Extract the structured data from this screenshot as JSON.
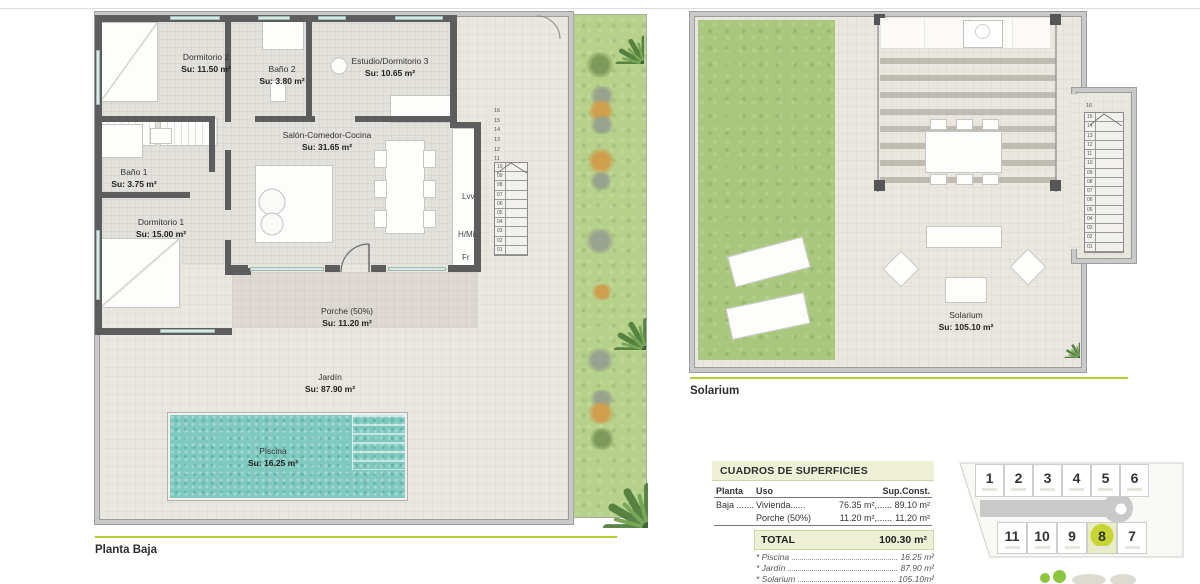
{
  "colors": {
    "accent_green": "#b6cc32",
    "plot_highlight": "#c4d336",
    "pool": "#7fc9bf",
    "grass": "#a9c87d",
    "garden_strip": "#b6d18a",
    "wall": "#5d5d5d",
    "table_header_bg": "#eef0d6"
  },
  "left_plan": {
    "section_label": "Planta Baja",
    "rooms": [
      {
        "name": "Dormitorio 2",
        "area": "Su: 11.50 m²"
      },
      {
        "name": "Baño 2",
        "area": "Su: 3.80 m²"
      },
      {
        "name": "Estudio/Dormitorio 3",
        "area": "Su: 10.65 m²"
      },
      {
        "name": "Salón-Comedor-Cocina",
        "area": "Su: 31.65 m²"
      },
      {
        "name": "Baño 1",
        "area": "Su: 3.75 m²"
      },
      {
        "name": "Dormitorio 1",
        "area": "Su: 15.00 m²"
      },
      {
        "name": "Porche (50%)",
        "area": "Su: 11.20 m²"
      },
      {
        "name": "Jardín",
        "area": "Su: 87.90 m²"
      },
      {
        "name": "Piscina",
        "area": "Su: 16.25 m²"
      }
    ],
    "appliances": [
      "Lvv",
      "H/Mi",
      "Fr"
    ],
    "stair_numbers_upper": [
      "16",
      "15",
      "14",
      "13",
      "12",
      "11"
    ],
    "stair_steps": [
      "10",
      "09",
      "08",
      "07",
      "06",
      "05",
      "04",
      "03",
      "02",
      "01"
    ]
  },
  "right_plan": {
    "section_label": "Solarium",
    "room": {
      "name": "Solarium",
      "area": "Su: 105.10 m²"
    },
    "stair_top_label": "16",
    "stair_steps": [
      "15",
      "14",
      "13",
      "12",
      "11",
      "10",
      "09",
      "08",
      "07",
      "06",
      "05",
      "04",
      "03",
      "02",
      "01"
    ]
  },
  "surfaces_table": {
    "title": "CUADROS DE SUPERFICIES",
    "headers": {
      "planta": "Planta",
      "uso": "Uso",
      "sup": "Sup.Const."
    },
    "rows": [
      {
        "planta": "Baja .......",
        "uso": "Vivienda......",
        "su": "76.35 m²,......",
        "const": "89.10 m²"
      },
      {
        "planta": "",
        "uso": "Porche (50%)",
        "su": "11.20 m²,......",
        "const": "11.20 m²"
      }
    ],
    "total_label": "TOTAL",
    "total_value": "100.30 m²",
    "extras": [
      {
        "label": "* Piscina",
        "value": "16.25 m²"
      },
      {
        "label": "* Jardín",
        "value": "87.90 m²"
      },
      {
        "label": "* Solarium",
        "value": "105.10m²"
      }
    ]
  },
  "plot_map": {
    "top_row": [
      "1",
      "2",
      "3",
      "4",
      "5",
      "6"
    ],
    "bottom_row": [
      "11",
      "10",
      "9",
      "8",
      "7"
    ],
    "highlighted": "8"
  }
}
